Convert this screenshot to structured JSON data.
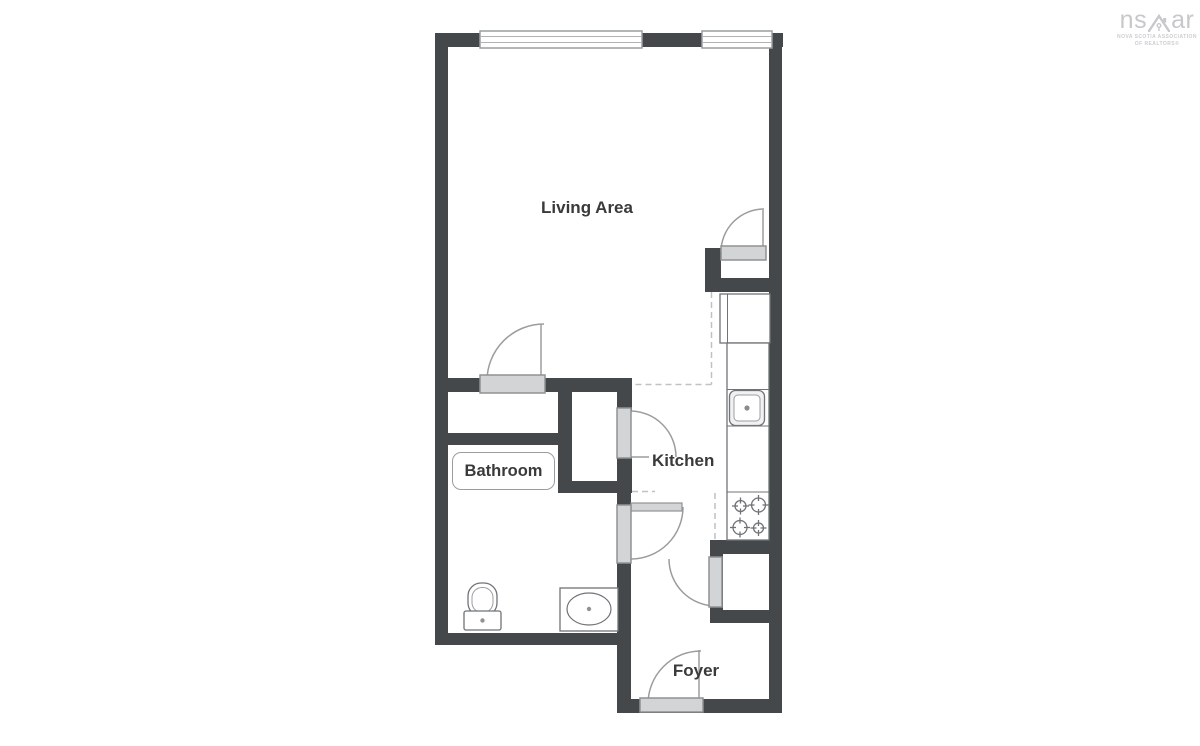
{
  "page": {
    "width": 1200,
    "height": 746,
    "background": "#ffffff"
  },
  "logo": {
    "brand_left": "ns",
    "brand_right": "ar",
    "house_icon": "house-roof-icon",
    "tagline_line1": "NOVA SCOTIA ASSOCIATION",
    "tagline_line2": "OF REALTORS®",
    "color": "#c6c8ca"
  },
  "floorplan": {
    "labels": {
      "living_area": "Living Area",
      "bathroom": "Bathroom",
      "kitchen": "Kitchen",
      "foyer": "Foyer"
    },
    "colors": {
      "wall": "#45484b",
      "door_slab": "#d2d4d6",
      "door_stroke": "#8f9294",
      "arc_stroke": "#9a9d9f",
      "fixture_stroke": "#6f7377",
      "dashed_line": "#bfc1c3",
      "window_stroke": "#9a9d9f",
      "label_text": "#3a3a3a"
    },
    "fixture_icons": [
      "toilet-icon",
      "vanity-sink-icon",
      "kitchen-sink-icon",
      "stove-burners-icon",
      "refrigerator-icon",
      "counter-icon"
    ],
    "feature_counts": {
      "windows": 2,
      "doors": 6,
      "closets": 3
    }
  }
}
